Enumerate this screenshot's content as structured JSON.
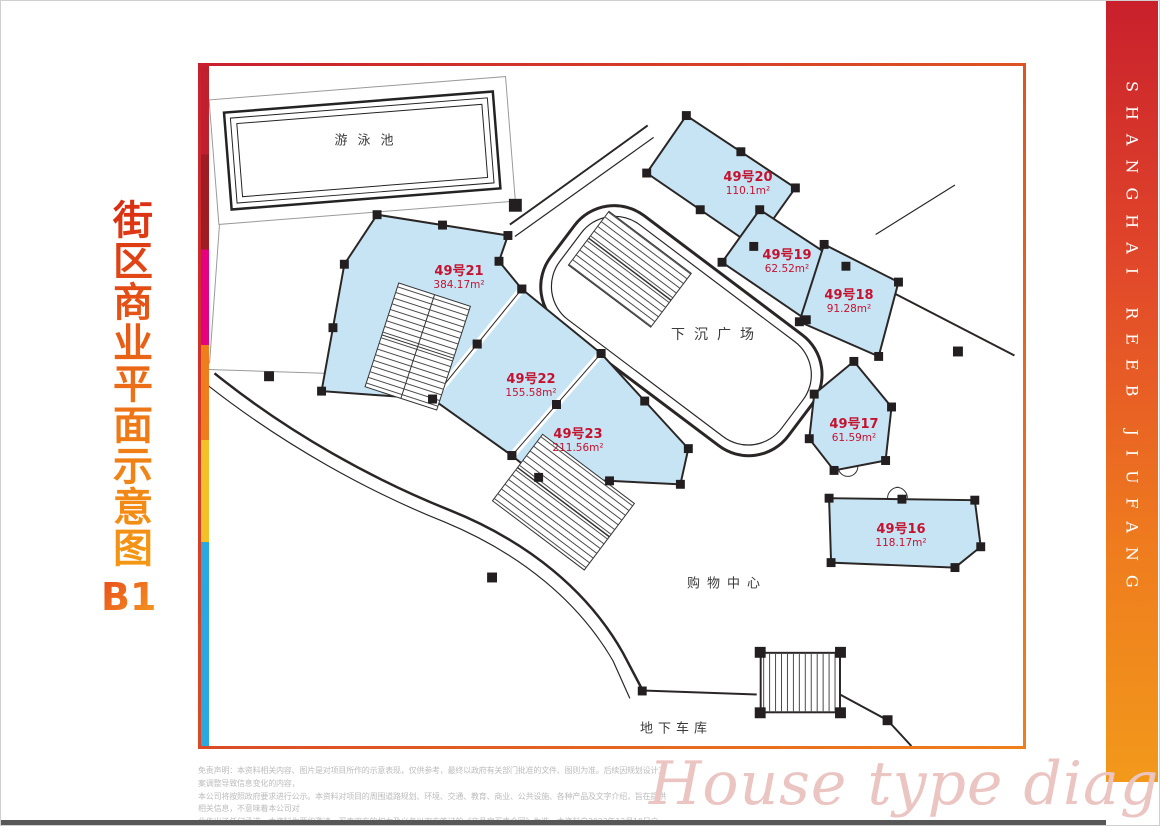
{
  "page_title": {
    "vertical": "街区商业平面示意图",
    "level": "B1"
  },
  "brand_bar": {
    "text": "SHANGHAI REEB JIUFANG"
  },
  "watermark": {
    "text": "House type diagram"
  },
  "plan": {
    "labels": {
      "pool": "游泳池",
      "plaza": "下沉广场",
      "mall": "购物中心",
      "garage": "地下车库"
    },
    "units": [
      {
        "id": "49号21",
        "area": "384.17m²"
      },
      {
        "id": "49号22",
        "area": "155.58m²"
      },
      {
        "id": "49号23",
        "area": "211.56m²"
      },
      {
        "id": "49号20",
        "area": "110.1m²"
      },
      {
        "id": "49号19",
        "area": "62.52m²"
      },
      {
        "id": "49号18",
        "area": "91.28m²"
      },
      {
        "id": "49号17",
        "area": "61.59m²"
      },
      {
        "id": "49号16",
        "area": "118.17m²"
      }
    ],
    "colors": {
      "unit_fill": "#c7e4f4",
      "unit_text": "#c4122f",
      "line": "#2b2626"
    }
  },
  "disclaimer": {
    "line1": "免责声明：本资料相关内容、图片是对项目所作的示意表现，仅供参考，最终以政府有关部门批准的文件、图则为准。后续因规划设计方案调整导致信息变化的内容，",
    "line2": "本公司将按照政府要求进行公示。本资料对项目的周围道路规划、环境、交通、教育、商业、公共设施、各种产品及文字介绍，旨在提供相关信息，不意味着本公司对",
    "line3": "此作出了任何承诺。本资料为要约邀请，买卖双方的权力及义务以双方签订的《商品房买卖合同》为准。本资料自2023年12月10日启用，后续请以最新资料内容为准。"
  }
}
